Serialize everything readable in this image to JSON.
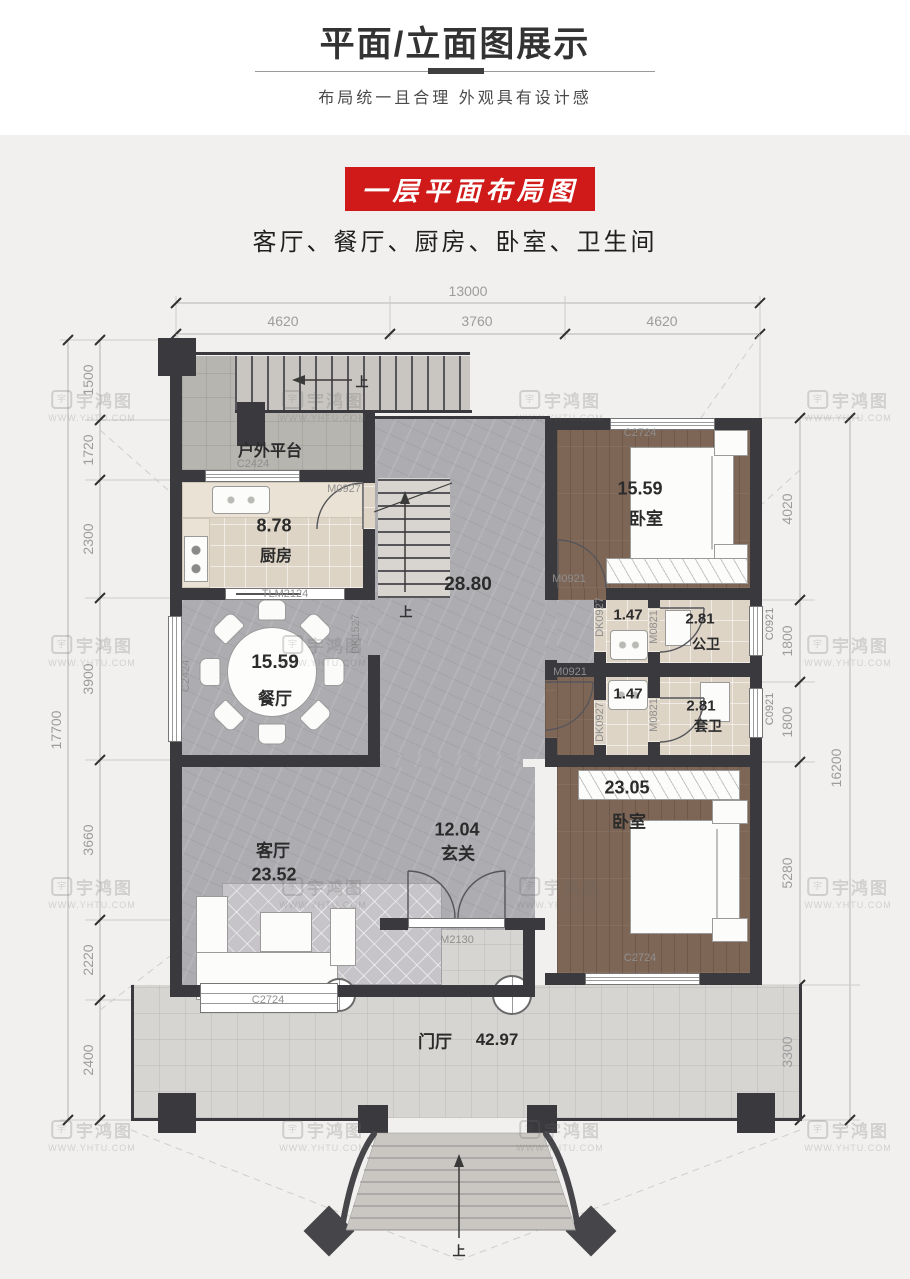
{
  "header": {
    "title": "平面/立面图展示",
    "subtitle": "布局统一且合理 外观具有设计感",
    "badge": "一层平面布局图",
    "rooms_line": "客厅、餐厅、厨房、卧室、卫生间"
  },
  "dims": {
    "top_total": "13000",
    "top_segs": [
      "4620",
      "3760",
      "4620"
    ],
    "left_segs": [
      "1500",
      "1720",
      "2300",
      "3900",
      "3660",
      "2220",
      "2400"
    ],
    "left_total": "17700",
    "right_segs": [
      "4020",
      "1800",
      "1800",
      "5280",
      "3300"
    ],
    "right_total": "16200"
  },
  "rooms": {
    "platform": "户外平台",
    "kitchen": "厨房",
    "kitchen_area": "8.78",
    "dining": "餐厅",
    "dining_area": "15.59",
    "living": "客厅",
    "living_area": "23.52",
    "hall_area": "28.80",
    "foyer": "玄关",
    "foyer_area": "12.04",
    "porch": "门厅",
    "porch_area": "42.97",
    "bedroom1": "卧室",
    "bedroom1_area": "15.59",
    "bedroom2": "卧室",
    "bedroom2_area": "23.05",
    "bath_public": "公卫",
    "bath_public_area": "2.81",
    "bath_suite": "套卫",
    "bath_suite_area": "2.81",
    "vestibule1_area": "1.47",
    "vestibule2_area": "1.47"
  },
  "openings": {
    "c2424_top": "C2424",
    "c2424_left": "C2424",
    "m0927": "M0927",
    "tlm2124": "TLM2124",
    "dk1527": "DK1527",
    "c2724_bed1": "C2724",
    "c2724_living": "C2724",
    "c2724_bed2": "C2724",
    "m0921_bed1": "M0921",
    "m0921_bed2": "M0921",
    "dk0927_a": "DK0927",
    "dk0927_b": "DK0927",
    "m0821_a": "M0821",
    "m0821_b": "M0821",
    "c0921_a": "C0921",
    "c0921_b": "C0921",
    "m2130": "M2130"
  },
  "annotations": {
    "up": "上"
  },
  "watermark": {
    "brand": "宇鸿图",
    "url": "WWW.YHTU.COM"
  },
  "colors": {
    "badge_red": "#d01a1a",
    "wall": "#3a3a3e",
    "marble_floor": "#adacb0",
    "wood_floor": "#7e6656",
    "tile_floor": "#ddd4c6",
    "porch_floor": "#d6d5d2"
  }
}
